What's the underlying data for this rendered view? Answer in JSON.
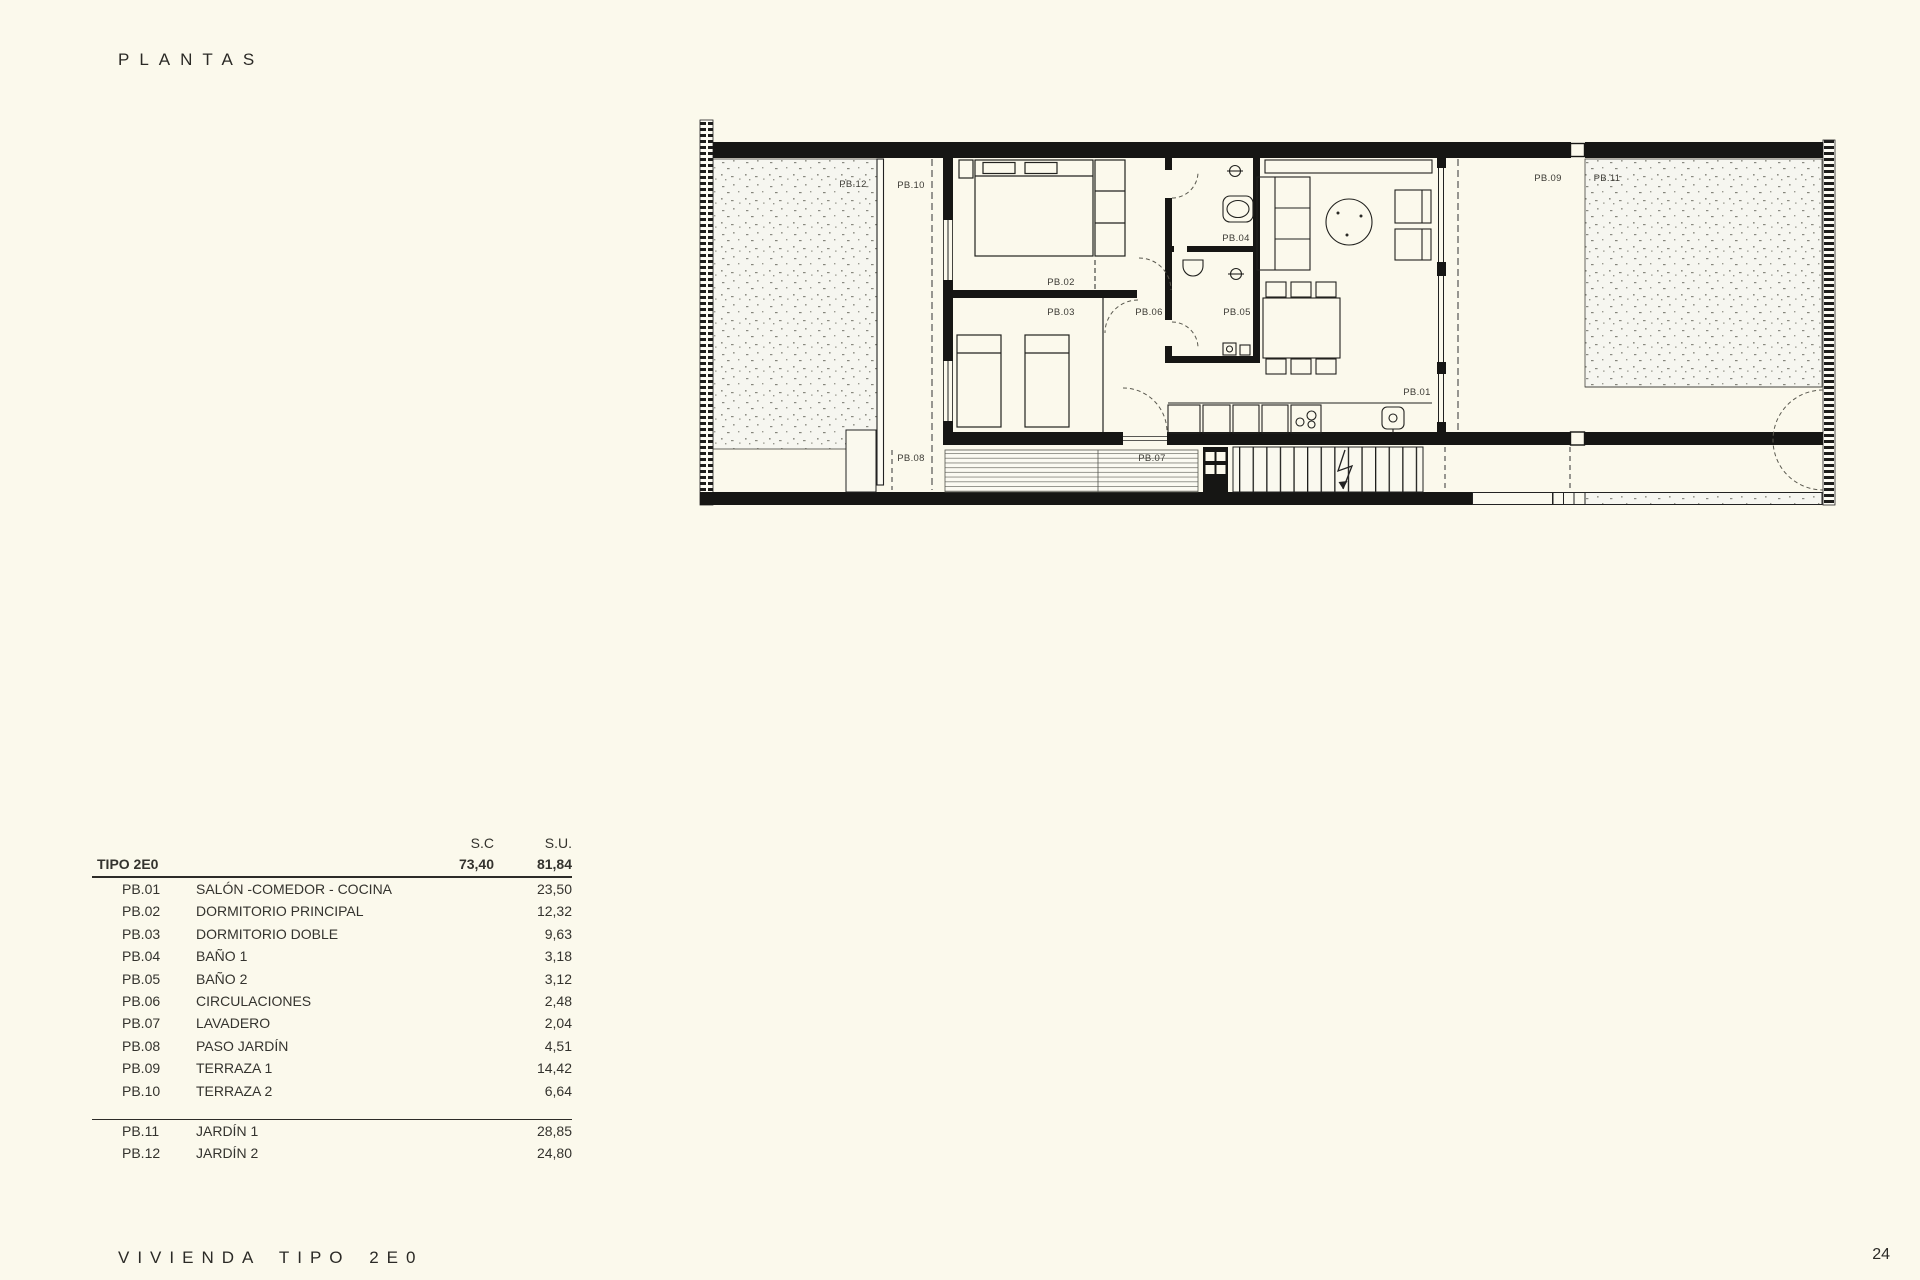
{
  "page": {
    "title": "PLANTAS",
    "footer_title": "VIVIENDA TIPO 2E0",
    "page_number": "24",
    "background_color": "#fbf9ec",
    "line_color": "#161614"
  },
  "plan": {
    "labels": {
      "pb01": "PB.01",
      "pb02": "PB.02",
      "pb03": "PB.03",
      "pb04": "PB.04",
      "pb05": "PB.05",
      "pb06": "PB.06",
      "pb07": "PB.07",
      "pb08": "PB.08",
      "pb09": "PB.09",
      "pb10": "PB.10",
      "pb11": "PB.11",
      "pb12": "PB.12"
    }
  },
  "table": {
    "col_sc": "S.C",
    "col_su": "S.U.",
    "header": {
      "name": "TIPO 2E0",
      "sc": "73,40",
      "su": "81,84"
    },
    "rows": [
      {
        "code": "PB.01",
        "name": "SALÓN -COMEDOR - COCINA",
        "sc": "",
        "su": "23,50"
      },
      {
        "code": "PB.02",
        "name": "DORMITORIO PRINCIPAL",
        "sc": "",
        "su": "12,32"
      },
      {
        "code": "PB.03",
        "name": "DORMITORIO DOBLE",
        "sc": "",
        "su": "9,63"
      },
      {
        "code": "PB.04",
        "name": "BAÑO 1",
        "sc": "",
        "su": "3,18"
      },
      {
        "code": "PB.05",
        "name": "BAÑO 2",
        "sc": "",
        "su": "3,12"
      },
      {
        "code": "PB.06",
        "name": "CIRCULACIONES",
        "sc": "",
        "su": "2,48"
      },
      {
        "code": "PB.07",
        "name": "LAVADERO",
        "sc": "",
        "su": "2,04"
      },
      {
        "code": "PB.08",
        "name": "PASO JARDÍN",
        "sc": "",
        "su": "4,51"
      },
      {
        "code": "PB.09",
        "name": "TERRAZA 1",
        "sc": "",
        "su": "14,42"
      },
      {
        "code": "PB.10",
        "name": "TERRAZA 2",
        "sc": "",
        "su": "6,64"
      }
    ],
    "rows_exterior": [
      {
        "code": "PB.11",
        "name": "JARDÍN 1",
        "sc": "",
        "su": "28,85"
      },
      {
        "code": "PB.12",
        "name": "JARDÍN 2",
        "sc": "",
        "su": "24,80"
      }
    ]
  }
}
